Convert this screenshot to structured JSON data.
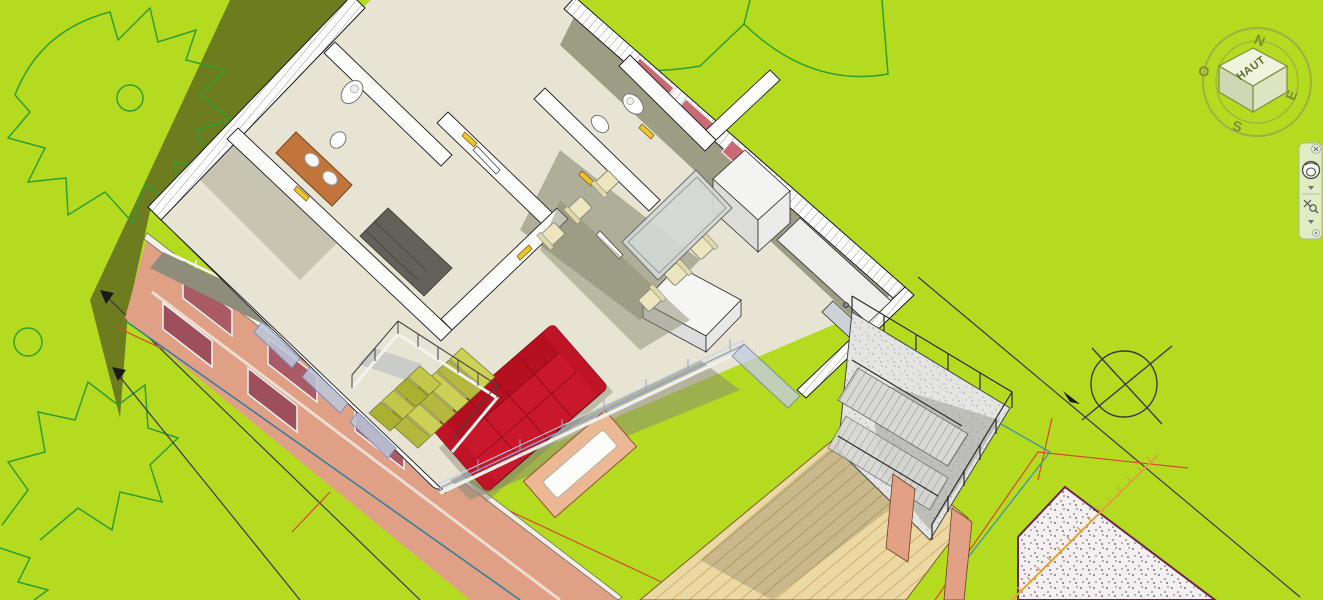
{
  "application": {
    "viewport_type": "3d-architectural-view",
    "description": "Rendered 3D cutaway view of a house model on bright green terrain with CAD annotation linework"
  },
  "viewcube": {
    "top_face_label": "HAUT",
    "compass": {
      "north": "N",
      "east": "E",
      "south": "S",
      "west": "O"
    }
  },
  "navigation_bar": {
    "tools": [
      {
        "name": "close"
      },
      {
        "name": "full-navigation-wheel"
      },
      {
        "name": "wheel-options-chevron"
      },
      {
        "name": "zoom"
      },
      {
        "name": "zoom-options-chevron"
      },
      {
        "name": "navigation-bar-options"
      }
    ]
  },
  "scene": {
    "elements": [
      "house-cutaway-model",
      "cast-shadow",
      "tree-outlines",
      "red-sofa",
      "coffee-table",
      "dining-table-with-chairs",
      "kitchen-units",
      "interior-staircase",
      "exterior-stair-terrace",
      "wood-deck",
      "gravel-patch",
      "survey-circle-marker",
      "dimension-lines",
      "property-lines",
      "fence-hatched-line",
      "glass-balustrade",
      "bathroom-fixtures"
    ],
    "colors": {
      "grass": "#b5db20",
      "shadow": "#6d7c1e",
      "tree_outline": "#2f9e33",
      "floor": "#e7e4d3",
      "wall_white": "#f7f7f6",
      "facade_salmon": "#dfa086",
      "window_maroon": "#a95a64",
      "sofa_red": "#c9182b",
      "stair_tread_yellow": "#ccd054",
      "deck_wood": "#ecd8a2",
      "glass_blue": "#bcc8dc",
      "dimension_red": "#d9472b",
      "dimension_black": "#3a3a3a",
      "dimension_teal": "#3a96aa",
      "fence_orange": "#dfa23f",
      "gravel_border": "#6e2145",
      "concrete": "#e4e4e2",
      "viewcube_face": "#f0f4dc",
      "ui_panel": "#e8efe2"
    }
  }
}
